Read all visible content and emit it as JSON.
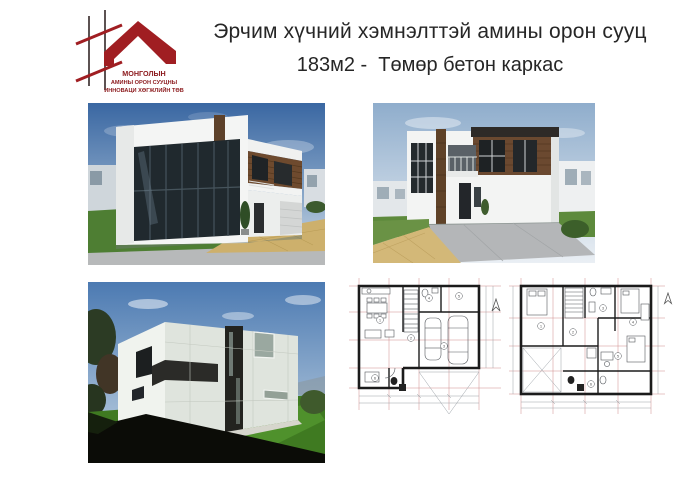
{
  "logo": {
    "line1": "МОНГОЛЫН",
    "line2": "АМИНЫ ОРОН СУУЦНЫ",
    "line3": "ИННОВАЦИ ХӨГЖЛИЙН ТӨВ",
    "brand_color": "#a01e22"
  },
  "title": {
    "line1": "Эрчим хүчний хэмнэлттэй амины орон сууц",
    "line2": "183м2 -  Төмөр бетон каркас",
    "color": "#262626"
  },
  "figures": {
    "render_corner": "3D render — corner view with large glazed facade",
    "render_front": "3D render — front view with driveway",
    "render_rear": "3D render — rear view on lawn",
    "plan_first_floor": "First floor plan with garage for two cars",
    "plan_second_floor": "Second floor plan with bedrooms"
  },
  "plans": {
    "first": {
      "markers": [
        "1",
        "2",
        "3",
        "4",
        "5",
        "6"
      ]
    },
    "second": {
      "markers": [
        "1",
        "2",
        "3",
        "4",
        "5",
        "6"
      ]
    }
  },
  "palette": {
    "sky_blue": "#3a67a2",
    "grass_green": "#4e7e33",
    "wood_brown": "#6b4930",
    "paver_tan": "#cdb06c",
    "plan_wall": "#1b1b1b",
    "driveway_gray": "#b4b6b8"
  }
}
